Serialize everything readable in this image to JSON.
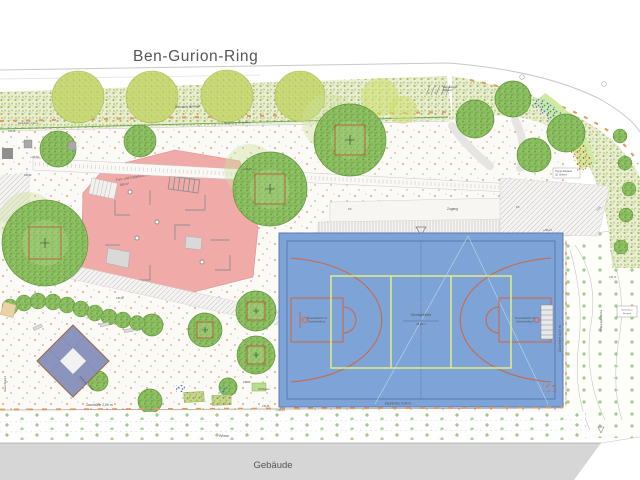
{
  "street": {
    "name": "Ben-Gurion-Ring"
  },
  "building": {
    "label": "Gebäude"
  },
  "meadow": {
    "label": "Wiese"
  },
  "access": {
    "label": "Zugang"
  },
  "planting": {
    "label": "Pflanzung Bestand"
  },
  "walls": {
    "support": "Stützmauer für Spieler",
    "mauer": "Mauer Bestand"
  },
  "fences": {
    "top": "Zaunhöhe 1,00 m",
    "left": "Zaunhöhe 2,00 m",
    "court_bottom": "Zaunhöhe 4,00 m",
    "court_right": "Zaunhöhe 4,00 m"
  },
  "court": {
    "center": "Kleinspielfeld",
    "dimension": "28,00 m",
    "left_line1": "Streetballkorb mit",
    "left_line2": "Basketballkorb",
    "right_line1": "Streetballkorb mit",
    "right_line2": "Basketballkorb"
  },
  "playground": {
    "line1": "Turn- und Calisthenics-Bereich",
    "line2": "250 m²",
    "pyramid": "Kletterpyramide",
    "beds": "Hochbeete"
  },
  "features": {
    "stairs_line1": "Treppe Bestand",
    "stairs_line2": "(11 Stufen)",
    "bike_line1": "Fahrradbügel",
    "bike_line2": "Bestand",
    "garden_line1": "Gartenhaus",
    "garden_line2": "Bestand",
    "garage": "Tiefgaragendecke",
    "slope": "4,0%",
    "slope2": "2%"
  },
  "elevations": [
    "136,98",
    "+136,56",
    "136,08",
    "+136,43",
    "136,50",
    "136,28",
    "136,36",
    "+136,15",
    "+136,24",
    "136,74"
  ],
  "colors": {
    "playground_pink": "#f0aaa8",
    "court_blue": "#7ea3d7",
    "court_lines_orange": "#c96a45",
    "court_lines_yellow": "#e3ec83",
    "tree_green": "#8bbd61",
    "light_tree_green": "#c8d877",
    "building_gray": "#d6d6d6",
    "fence_orange": "#e09a5e",
    "pyramid_blue": "#8b94bd"
  }
}
